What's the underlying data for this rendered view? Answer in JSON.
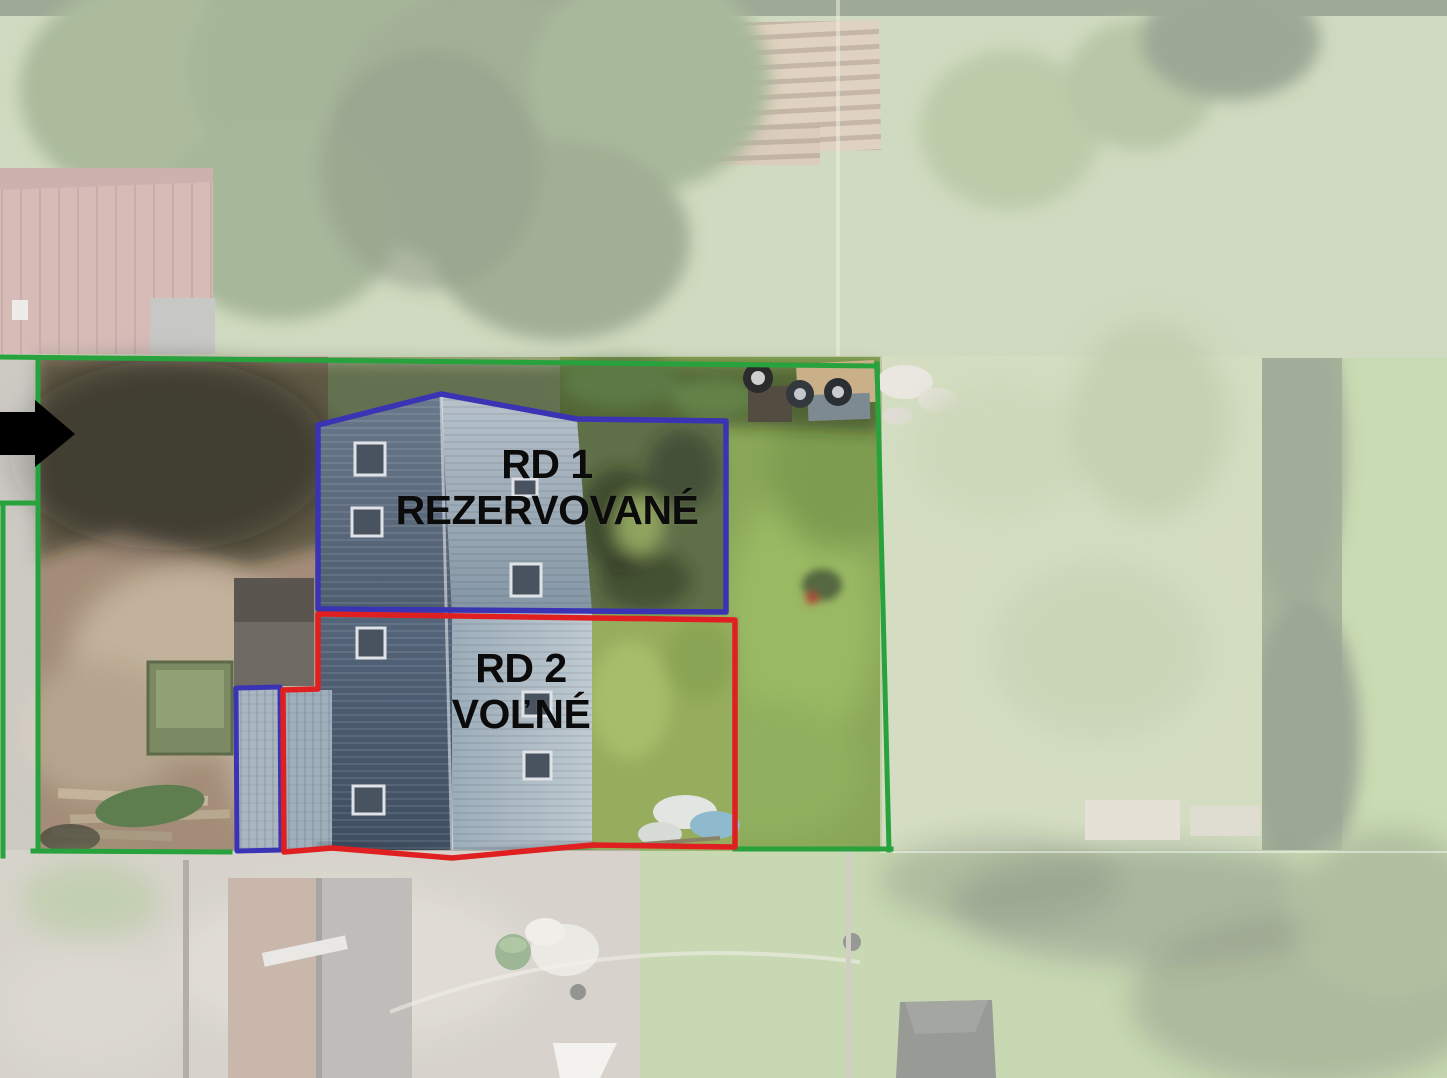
{
  "labels": {
    "rd1_line1": "RD 1",
    "rd1_line2": "REZERVOVANÉ",
    "rd2_line1": "RD 2",
    "rd2_line2": "VOĽNÉ"
  },
  "colors": {
    "plot_boundary_green": "#27a23c",
    "rd1_outline_blue": "#3a34b4",
    "rd2_outline_red": "#e02020",
    "label_text": "#0b0b0b",
    "arrow_black": "#000000"
  },
  "icons": {
    "entrance_arrow": "right-arrow-icon"
  }
}
